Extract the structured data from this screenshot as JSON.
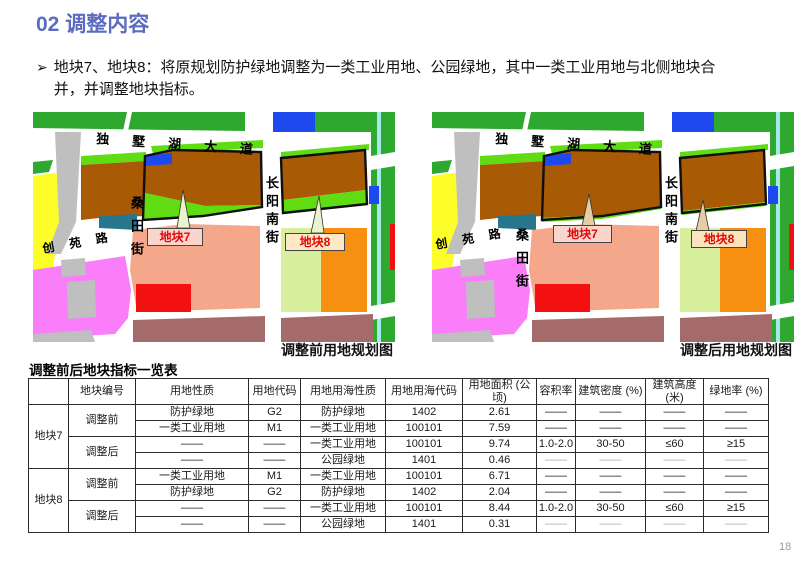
{
  "header": {
    "title": "02 调整内容",
    "accent_color": "#5b6cc0"
  },
  "bullet": {
    "marker": "➢",
    "text": "地块7、地块8：将原规划防护绿地调整为一类工业用地、公园绿地，其中一类工业用地与北侧地块合并，并调整地块指标。"
  },
  "maps": {
    "streets": {
      "avenue": "独墅湖大道",
      "sangtian": "桑田街",
      "chuangyuan": "创苑路",
      "changyang": "长阳南街"
    },
    "before": {
      "caption": "调整前用地规划图",
      "block7_label": "地块7",
      "block8_label": "地块8"
    },
    "after": {
      "caption": "调整后用地规划图",
      "block7_label": "地块7",
      "block8_label": "地块8"
    }
  },
  "map_colors": {
    "g1": "#2fa82f",
    "g2": "#5fdd12",
    "brown": "#a95a05",
    "blue": "#1d49ee",
    "teal": "#27768e",
    "yellow": "#fdfd2a",
    "gray": "#bfbfbf",
    "magenta": "#fa7dfa",
    "salmon": "#f4a78a",
    "red": "#f31010",
    "maroon": "#a56a6a",
    "orange": "#f78f11",
    "lgreen": "#d8ef9e",
    "cyan": "#a5e9ea",
    "white": "#ffffff"
  },
  "table": {
    "title": "调整前后地块指标一览表",
    "headers": [
      "",
      "地块编号",
      "用地性质",
      "用地代码",
      "用地用海性质",
      "用地用海代码",
      "用地面积 (公顷)",
      "容积率",
      "建筑密度 (%)",
      "建筑高度\n(米)",
      "绿地率 (%)"
    ],
    "blocks": [
      {
        "id": "地块7",
        "groups": [
          {
            "stage": "调整前",
            "rows": [
              [
                "防护绿地",
                "G2",
                "防护绿地",
                "1402",
                "2.61",
                "——",
                "——",
                "——",
                "——"
              ],
              [
                "一类工业用地",
                "M1",
                "一类工业用地",
                "100101",
                "7.59",
                "——",
                "——",
                "——",
                "——"
              ]
            ]
          },
          {
            "stage": "调整后",
            "rows": [
              [
                "——",
                "——",
                "一类工业用地",
                "100101",
                "9.74",
                "1.0-2.0",
                "30-50",
                "≤60",
                "≥15"
              ],
              [
                "——",
                "——",
                "公园绿地",
                "1401",
                "0.46",
                "——",
                "——",
                "——",
                "——"
              ]
            ]
          }
        ]
      },
      {
        "id": "地块8",
        "groups": [
          {
            "stage": "调整前",
            "rows": [
              [
                "一类工业用地",
                "M1",
                "一类工业用地",
                "100101",
                "6.71",
                "——",
                "——",
                "——",
                "——"
              ],
              [
                "防护绿地",
                "G2",
                "防护绿地",
                "1402",
                "2.04",
                "——",
                "——",
                "——",
                "——"
              ]
            ]
          },
          {
            "stage": "调整后",
            "rows": [
              [
                "——",
                "——",
                "一类工业用地",
                "100101",
                "8.44",
                "1.0-2.0",
                "30-50",
                "≤60",
                "≥15"
              ],
              [
                "——",
                "——",
                "公园绿地",
                "1401",
                "0.31",
                "——",
                "——",
                "——",
                "——"
              ]
            ]
          }
        ]
      }
    ]
  },
  "footer": {
    "page_number": "18"
  }
}
